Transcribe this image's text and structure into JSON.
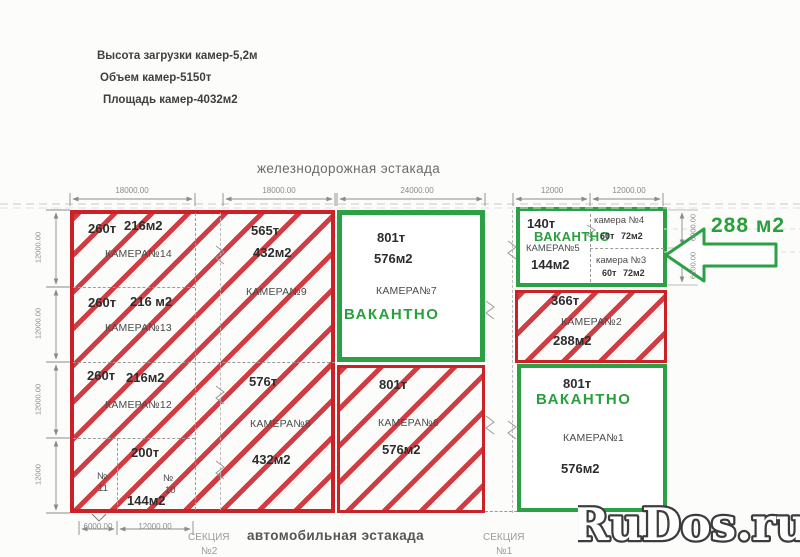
{
  "header": {
    "line1": "Высота загрузки камер-5,2м",
    "line2": "Объем камер-5150т",
    "line3": "Площадь камер-4032м2"
  },
  "labels": {
    "railway": "железнодорожная эстакада",
    "road": "автомобильная эстакада",
    "section2_line1": "СЕКЦИЯ",
    "section2_line2": "№2",
    "section1_line1": "СЕКЦИЯ",
    "section1_line2": "№1",
    "highlight_area": "288 м2",
    "watermark": "RuDos.ru"
  },
  "dimensions": {
    "top": [
      "18000.00",
      "18000.00",
      "24000.00",
      "12000",
      "12000.00"
    ],
    "left": [
      "12000.00",
      "12000.00",
      "12000.00",
      "12000"
    ],
    "right": [
      "6000.00",
      "6100.00"
    ],
    "bottom": [
      "6000.00",
      "12000.00"
    ]
  },
  "chambers": {
    "c14": {
      "tons": "260т",
      "area": "216м2",
      "name": "КАМЕРА№14"
    },
    "c13": {
      "tons": "260т",
      "area": "216 м2",
      "name": "КАМЕРА№13"
    },
    "c12": {
      "tons": "260т",
      "area": "216м2",
      "name": "КАМЕРА№12"
    },
    "c11": {
      "num_sign": "№",
      "num": "11"
    },
    "c10": {
      "tons": "200т",
      "num_sign": "№",
      "num": "10",
      "area": "144м2"
    },
    "c9": {
      "tons": "565т",
      "area": "432м2",
      "name": "КАМЕРА№9"
    },
    "c8": {
      "tons": "576т",
      "area": "432м2",
      "name": "КАМЕРА№8"
    },
    "c7": {
      "tons": "801т",
      "area": "576м2",
      "name": "КАМЕРА№7",
      "status": "ВАКАНТНО"
    },
    "c6": {
      "tons": "801т",
      "area": "576м2",
      "name": "КАМЕРА№6"
    },
    "c5": {
      "tons": "140т",
      "status": "ВАКАНТНО",
      "name": "КАМЕРА№5",
      "area": "144м2"
    },
    "c4": {
      "name": "камера №4",
      "tons": "60т",
      "area": "72м2"
    },
    "c3": {
      "name": "камера №3",
      "tons": "60т",
      "area": "72м2"
    },
    "c2": {
      "tons": "366т",
      "name": "КАМЕРА№2",
      "area": "288м2"
    },
    "c1": {
      "tons": "801т",
      "status": "ВАКАНТНО",
      "name": "КАМЕРА№1",
      "area": "576м2"
    }
  },
  "colors": {
    "occupied_red": "#cb2228",
    "vacant_green": "#2ca044",
    "dim_gray": "#8b8b8b"
  }
}
